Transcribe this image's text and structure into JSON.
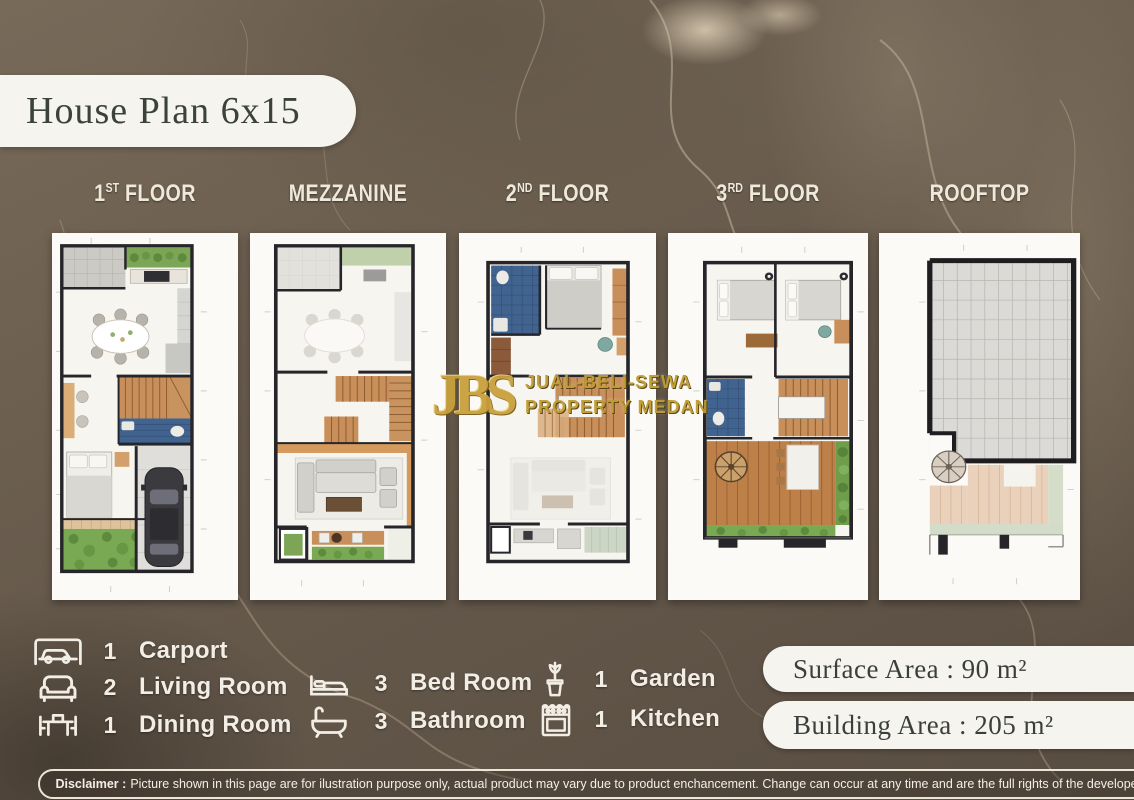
{
  "title": "House Plan 6x15",
  "floors": [
    {
      "num": "1",
      "sup": "ST",
      "rest": " FLOOR"
    },
    {
      "num": "MEZZANINE",
      "sup": "",
      "rest": ""
    },
    {
      "num": "2",
      "sup": "ND",
      "rest": " FLOOR"
    },
    {
      "num": "3",
      "sup": "RD",
      "rest": " FLOOR"
    },
    {
      "num": "ROOFTOP",
      "sup": "",
      "rest": ""
    }
  ],
  "legend": {
    "columns": [
      {
        "items": [
          {
            "icon": "car-icon",
            "count": "1",
            "label": "Carport"
          },
          {
            "icon": "sofa-icon",
            "count": "2",
            "label": "Living Room"
          },
          {
            "icon": "dining-table-icon",
            "count": "1",
            "label": "Dining Room"
          }
        ]
      },
      {
        "items": [
          {
            "icon": "bed-icon",
            "count": "3",
            "label": "Bed Room"
          },
          {
            "icon": "bathtub-icon",
            "count": "3",
            "label": "Bathroom"
          }
        ]
      },
      {
        "items": [
          {
            "icon": "plant-icon",
            "count": "1",
            "label": "Garden"
          },
          {
            "icon": "stove-icon",
            "count": "1",
            "label": "Kitchen"
          }
        ]
      }
    ]
  },
  "area": {
    "surface": "Surface Area : 90 m²",
    "building": "Building Area : 205 m²"
  },
  "watermark": {
    "initials": "JBS",
    "line1": "JUAL-BELI-SEWA",
    "line2": "PROPERTY MEDAN"
  },
  "disclaimer": {
    "label": "Disclaimer :",
    "text": "Picture shown in this page are for ilustration purpose only, actual product may vary due to product enchancement. Change can occur at any time and are the full rights of the developer."
  },
  "colors": {
    "background": "#6b5e4f",
    "pill": "#f6f4ee",
    "gold": "#c9a03c",
    "text_dark": "#3b423d",
    "label_light": "#efe9dc"
  }
}
